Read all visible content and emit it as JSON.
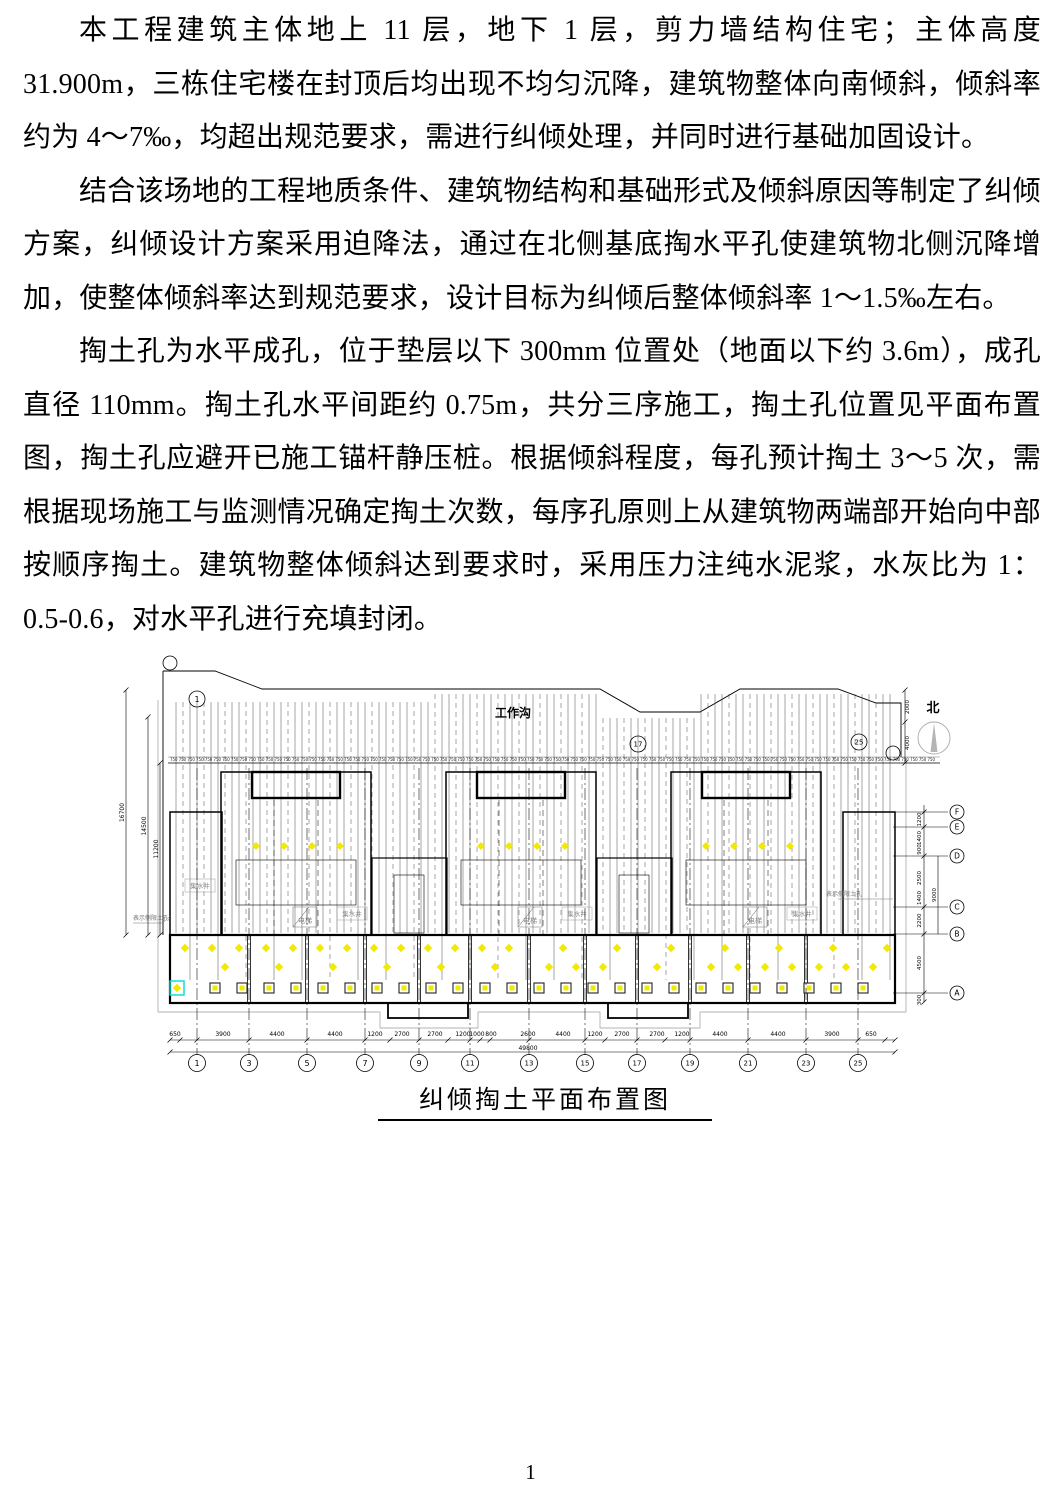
{
  "page": {
    "number": "1"
  },
  "paragraphs": [
    {
      "text": "本工程建筑主体地上 11 层，地下 1 层，剪力墙结构住宅；主体高度 31.900m，三栋住宅楼在封顶后均出现不均匀沉降，建筑物整体向南倾斜，倾斜率约为 4～7‰，均超出规范要求，需进行纠倾处理，并同时进行基础加固设计。"
    },
    {
      "text": "结合该场地的工程地质条件、建筑物结构和基础形式及倾斜原因等制定了纠倾方案，纠倾设计方案采用迫降法，通过在北侧基底掏水平孔使建筑物北侧沉降增加，使整体倾斜率达到规范要求，设计目标为纠倾后整体倾斜率 1～1.5‰左右。"
    },
    {
      "text": "掏土孔为水平成孔，位于垫层以下 300mm 位置处（地面以下约 3.6m），成孔直径 110mm。掏土孔水平间距约 0.75m，共分三序施工，掏土孔位置见平面布置图，掏土孔应避开已施工锚杆静压桩。根据倾斜程度，每孔预计掏土 3～5 次，需根据现场施工与监测情况确定掏土次数，每序孔原则上从建筑物两端部开始向中部按顺序掏土。建筑物整体倾斜达到要求时，采用压力注纯水泥浆，水灰比为 1：0.5-0.6，对水平孔进行充填封闭。"
    }
  ],
  "drawing": {
    "title": "纠倾掏土平面布置图",
    "trench_label": "工作沟",
    "north_label": "北",
    "hole_spacing": "750",
    "note_left": "表示侧限土孔",
    "note_right": "表示侧限土孔",
    "room_labels": {
      "elevator": "电梯",
      "sump": "集水井"
    },
    "markers": {
      "top_left": "1",
      "middle": "17",
      "right": "25"
    },
    "axis_numbers": [
      "1",
      "3",
      "5",
      "7",
      "9",
      "11",
      "13",
      "15",
      "17",
      "19",
      "21",
      "23",
      "25"
    ],
    "axis_letters": [
      "F",
      "E",
      "D",
      "C",
      "B",
      "A"
    ],
    "bottom_dims": [
      "650",
      "3900",
      "4400",
      "4400",
      "1200",
      "2700",
      "2700",
      "1200",
      "1000",
      "800",
      "2600",
      "4400",
      "1200",
      "2700",
      "2700",
      "1200",
      "4400",
      "4400",
      "3900",
      "650"
    ],
    "bottom_total": "49800",
    "left_dims": [
      "11200",
      "14500",
      "16700"
    ],
    "right_dims": [
      "1200",
      "1400",
      "900",
      "2500",
      "1400",
      "2200",
      "4500",
      "300"
    ],
    "right_inner_total": "9000",
    "top_right_dims": [
      "2000",
      "4000"
    ],
    "colors": {
      "marker_yellow": "#f2e900",
      "highlight_cyan": "#00dcdc"
    }
  }
}
